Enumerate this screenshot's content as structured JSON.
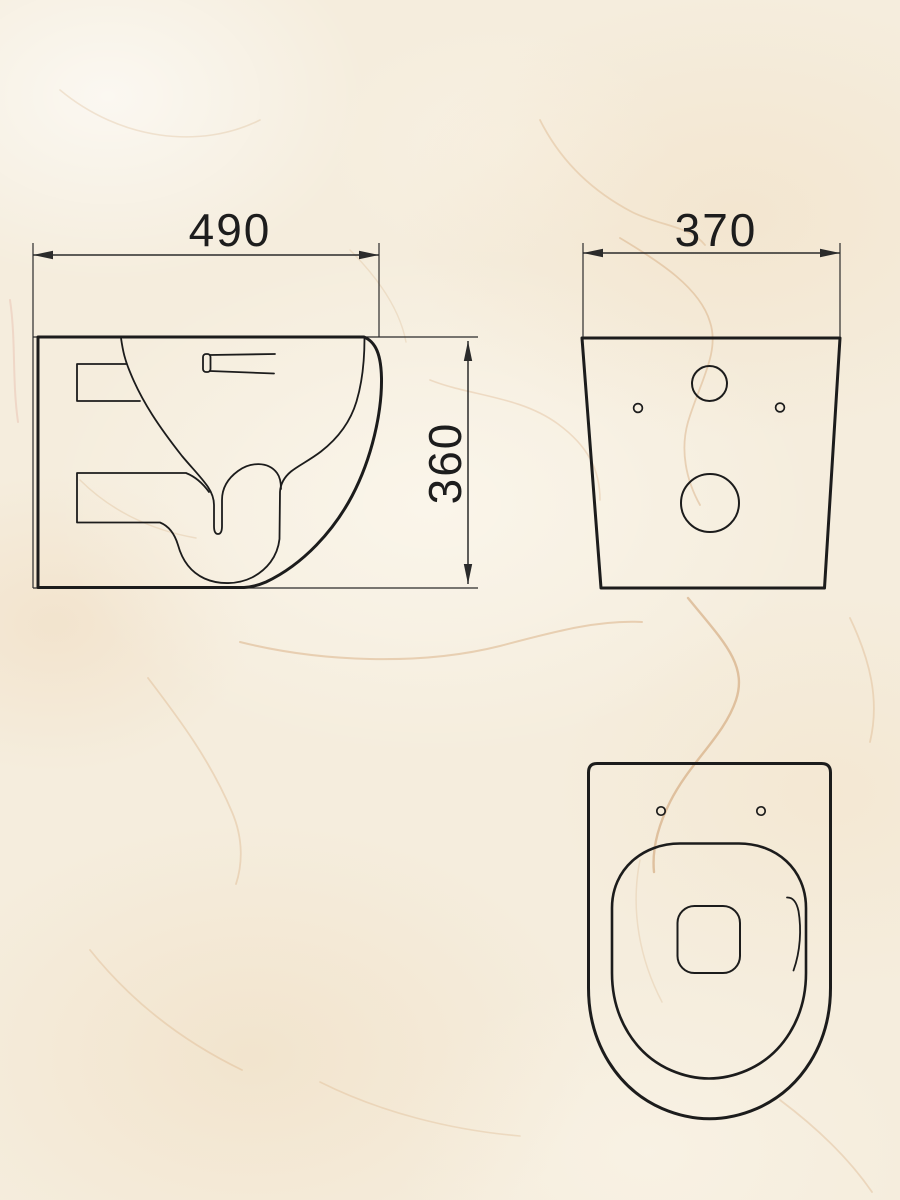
{
  "drawing": {
    "type": "technical-dimension-drawing",
    "dimensions": {
      "side_width": "490",
      "side_height": "360",
      "back_width": "370"
    },
    "colors": {
      "line": "#1c1c1c",
      "dimension_line": "#2b2b2b",
      "background": "#f5eddd",
      "vein": "#c08b52"
    }
  }
}
